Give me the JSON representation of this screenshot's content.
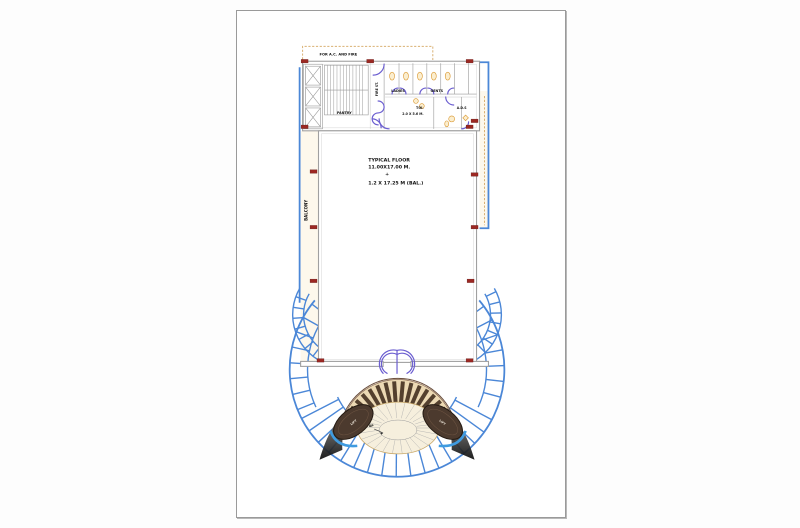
{
  "window": {
    "background": "#fdfdfd"
  },
  "page": {
    "background": "#ffffff",
    "border_color": "#9a9a9a"
  },
  "colors": {
    "line_blue": "#4b87d7",
    "door_violet": "#6b5ed0",
    "wall_gray": "#a0a0a0",
    "column_red": "#9c2823",
    "duct_tan": "#d9b072",
    "fan_blade_brown": "#54402e",
    "fan_cream": "#ecd9b4",
    "lift_pod_brown": "#4c3a2e",
    "text_black": "#141414"
  },
  "plan": {
    "labels": {
      "service_zone": "FOR A.C. AND FIRE",
      "pantry": "PANTRY",
      "fire_stair": "FIRE ST.",
      "ladies": "LADIES",
      "gents": "GENTS",
      "toilet": "TOI.",
      "toilet_size": "2.0 X 5.6 M.",
      "ads": "A.D.S",
      "balcony": "BALCONY",
      "floor_title": "TYPICAL FLOOR",
      "floor_dims": "11.00X17.00 M.",
      "plus_sign": "+",
      "balcony_dims": "1.2 X 17.25 M (BAL.)",
      "lift_left": "LIFT",
      "lift_right": "LIFT",
      "up": "UP"
    }
  }
}
